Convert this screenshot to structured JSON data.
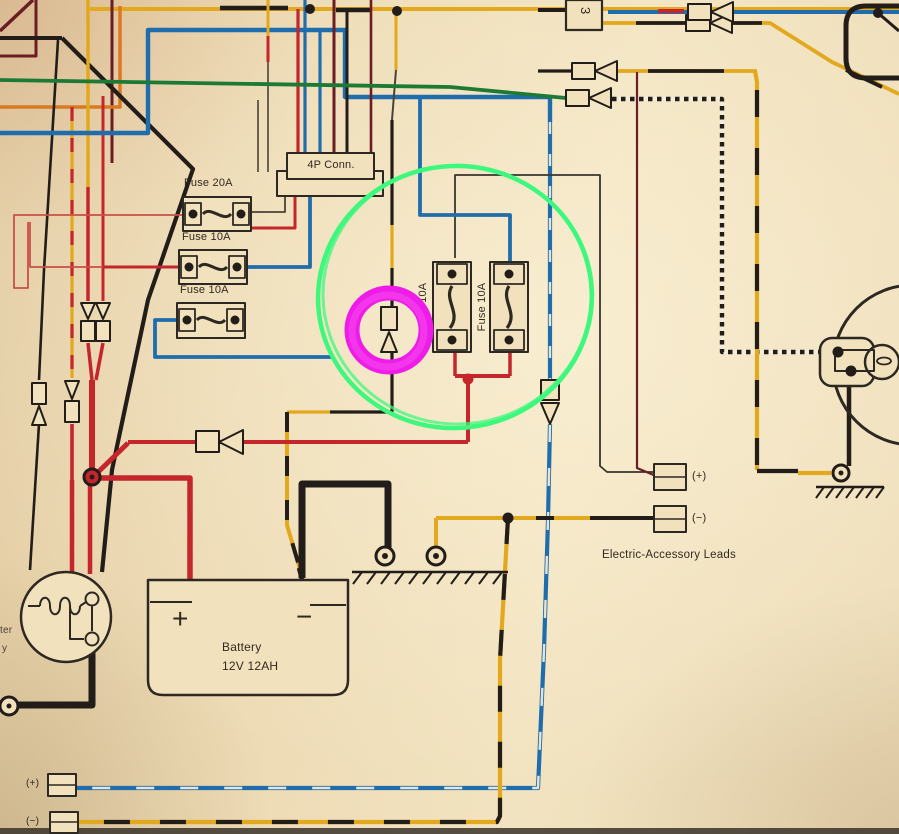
{
  "diagram": {
    "title": "Motorcycle wiring diagram photo with annotation circles",
    "labels": {
      "connector_4p": "4P Conn.",
      "fuse_20a": "Fuse 20A",
      "fuse_10a_row2": "Fuse 10A",
      "fuse_10a_row3": "Fuse 10A",
      "fuse_10a_vertical_left": "Fuse 10A",
      "fuse_10a_vertical_right": "Fuse 10A",
      "battery_name": "Battery",
      "battery_spec": "12V 12AH",
      "battery_plus": "+",
      "battery_minus": "−",
      "accessory_leads_caption": "Electric-Accessory Leads",
      "accessory_plus": "(+)",
      "accessory_minus": "(−)",
      "bottom_lead_plus": "(+)",
      "bottom_lead_minus": "(−)",
      "connector_block_3": "3",
      "edge_text_line1": "ter",
      "edge_text_line2": "y"
    },
    "annotations": {
      "green_circle_note": "hand-drawn green circle around center fuse / connector area",
      "magenta_circle_note": "magenta marker circle highlighting bullet connector",
      "green_color": "#3df87d",
      "magenta_color": "#ef1be8"
    },
    "colors": {
      "paper": "#ecd9b2",
      "wire_red": "#c4262c",
      "wire_blue": "#1f6dad",
      "wire_yellow": "#e2a81e",
      "wire_orange": "#d97922",
      "wire_green": "#1d7a35",
      "wire_black": "#221d18",
      "wire_maroon": "#6b1d24",
      "ink": "#2e2822"
    }
  }
}
